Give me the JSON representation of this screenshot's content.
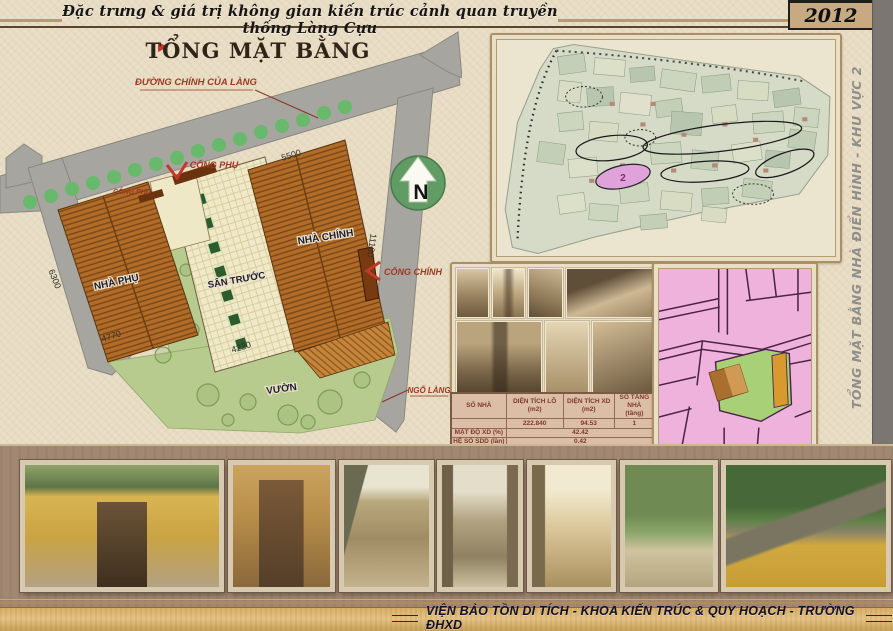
{
  "header": {
    "title": "Đặc trưng & giá trị không gian kiến trúc cảnh quan truyền thống Làng Cựu",
    "year": "2012"
  },
  "sidebar": {
    "label": "TỔNG MẶT BẰNG NHÀ ĐIỂN HÌNH - KHU VỰC 2"
  },
  "plan": {
    "title": "TỔNG MẶT BẰNG",
    "road_label": "ĐƯỜNG CHÍNH CỦA LÀNG",
    "gate_side_top": "CỔNG PHỤ",
    "gate_side_left": "CỔNG PHỤ",
    "main_house": "NHÀ CHÍNH",
    "aux_house": "NHÀ PHỤ",
    "front_yard": "SÂN TRƯỚC",
    "main_gate": "CỔNG CHÍNH",
    "garden": "VƯỜN",
    "alley": "NGÕ LÀNG",
    "north": "N",
    "dims": {
      "d5500": "5500",
      "d11160": "11160",
      "d6300": "6300",
      "d4770": "4770",
      "d4220": "4220"
    }
  },
  "village_map": {
    "zone": "2"
  },
  "table": {
    "headers": [
      {
        "name": "SỐ NHÀ",
        "unit": ""
      },
      {
        "name": "DIỆN TÍCH LÔ",
        "unit": "(m2)"
      },
      {
        "name": "DIỆN TÍCH XD",
        "unit": "(m2)"
      },
      {
        "name": "SỐ TẦNG NHÀ",
        "unit": "(tầng)"
      }
    ],
    "row1": {
      "so_nha": "",
      "dt_lo": "222.840",
      "dt_xd": "94.53",
      "so_tang": "1"
    },
    "row2": {
      "label": "MẬT ĐỘ XD",
      "unit": "(%)",
      "value": "42.42"
    },
    "row3": {
      "label": "HỆ SỐ SDD",
      "unit": "(lần)",
      "value": "0.42"
    }
  },
  "footer": {
    "text": "VIỆN BẢO TỒN DI TÍCH - KHOA KIẾN TRÚC & QUY HOẠCH - TRƯỜNG ĐHXD"
  },
  "colors": {
    "accent_red": "#9c3a22",
    "road_grey": "#a6a5a0",
    "tree_green": "#68b96b",
    "roof_brown": "#b06c28",
    "garden_green": "#b7cb8f",
    "courtyard_cream": "#f0e9c8",
    "map_pink": "#efb2dc",
    "band_brown": "#a28873",
    "gold_strip": "#d9b36d"
  }
}
